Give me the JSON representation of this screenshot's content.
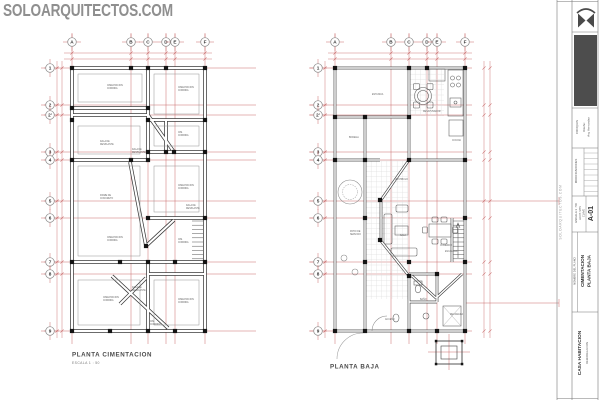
{
  "watermark": "SOLOARQUITECTOS.COM",
  "margin_text": "SOLOARQUITECTOS.COM",
  "colors": {
    "axis_red": "#c96b6b",
    "wall": "#3a3a3a",
    "column_black": "#141414",
    "furniture": "#5a5a5a",
    "tile": "#dcdcdc",
    "watermark_gray": "#8f8f8f",
    "dark_box": "#4d4d4d",
    "logo": "#4a4a4a",
    "border": "#777777",
    "label_gray": "#666666"
  },
  "plans": {
    "left": {
      "title": "PLANTA CIMENTACION",
      "scale": "ESCALA 1 : 50",
      "cols": [
        "A",
        "B",
        "C",
        "D",
        "E",
        "F"
      ],
      "rows": [
        "1",
        "2",
        "2'",
        "3",
        "4",
        "5",
        "6",
        "7",
        "8",
        "9"
      ],
      "annotations": [
        "CIMENTACION CORRIDA",
        "CIMENTACION CORRIDA",
        "DALA DE DESPLANTE",
        "CIM. CORRIDA",
        "DALA DE DESPLANTE",
        "CIMENTACION CORRIDA",
        "FIRME DE CONCRETO",
        "DALA DE DESPLANTE",
        "CIMENTACION CORRIDA",
        "CIM. CORRIDA",
        "DALA DE DESPLANTE",
        "CIMENTACION CORRIDA",
        "CIMENTACION CORRIDA",
        "CIM. CORRIDA"
      ]
    },
    "right": {
      "title": "PLANTA BAJA",
      "cols": [
        "A",
        "B",
        "C",
        "D",
        "E",
        "F"
      ],
      "rows": [
        "1",
        "2",
        "2'",
        "3",
        "4",
        "5",
        "6",
        "7",
        "8",
        "9"
      ],
      "annotations": [
        "ESTANCIA",
        "DESAYUNADOR",
        "COCINA",
        "BODEGA",
        "PATIO DE SERVICIO",
        "SALA",
        "COMEDOR",
        "ESCALERA",
        "BAÑO",
        "RECAMARA",
        "ACCESO",
        "VESTIBULO"
      ]
    }
  },
  "title_block": {
    "croquis": "CROQUIS",
    "diseno": "Diseño:",
    "disenador": "Arq. Hernandez",
    "modificaciones": "MODIFICACIONES",
    "escala": "ESCALA 1 : 50",
    "acot": "ACOT. MTS",
    "clave": "CLAVE",
    "sheet": "A-01",
    "name_label": "NOMBRE DEL PLANO",
    "name_line1": "CIMENTACION",
    "name_line2": "PLANTA BAJA",
    "project": "CASA HABITACION",
    "project_sub": "REMODELACION"
  }
}
